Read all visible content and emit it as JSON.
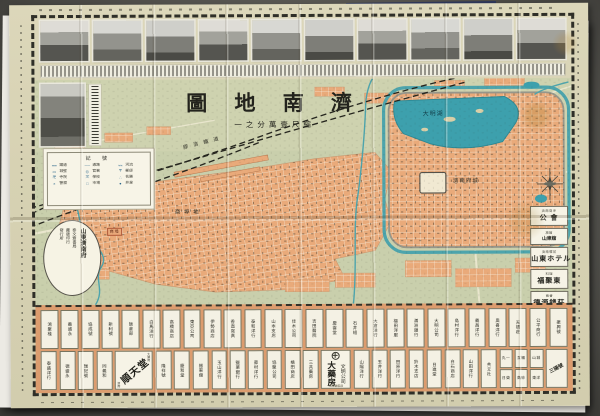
{
  "colors": {
    "paper": "#d7d2b3",
    "map_green": "#c9cfac",
    "block_orange": "#e9aa7a",
    "lake_teal": "#3da0ad",
    "ads_band": "#dc9c6e"
  },
  "title": {
    "text": "濟南地圖",
    "display": "圖 地 南 濟",
    "subtitle": "縮尺壹萬分之一",
    "subtitle_display": "一之分萬壹尺縮"
  },
  "photos_row": [
    "church-building",
    "river-landscape",
    "street-view",
    "cathedral-street",
    "government-building",
    "iron-bridge",
    "railway-station",
    "temple-gate",
    "garden-residence",
    "office-building"
  ],
  "left_photo": "spring-temple-photo",
  "legend": {
    "title": "記 號",
    "items": [
      {
        "sym": "━━",
        "label": "鐵道"
      },
      {
        "sym": "──",
        "label": "道路"
      },
      {
        "sym": "≈≈",
        "label": "河流"
      },
      {
        "sym": "▭",
        "label": "城壁"
      },
      {
        "sym": "◎",
        "label": "官署"
      },
      {
        "sym": "〒",
        "label": "郵便"
      },
      {
        "sym": "卍",
        "label": "寺院"
      },
      {
        "sym": "文",
        "label": "學校"
      },
      {
        "sym": "∴",
        "label": "名勝"
      },
      {
        "sym": "×",
        "label": "警察"
      },
      {
        "sym": "□",
        "label": "市場"
      },
      {
        "sym": "●",
        "label": "井泉"
      }
    ]
  },
  "cartouche": {
    "lines": [
      "山東濟南府",
      "泰文齋書局",
      "藏版印行",
      "發行所"
    ]
  },
  "map_labels": [
    {
      "text": "膠 濟 鐵 道"
    },
    {
      "text": "商 埠 地"
    },
    {
      "text": "大明湖"
    },
    {
      "text": "濟南府城"
    }
  ],
  "chip_label": "商埠",
  "right_boxes": [
    {
      "top": "濟南商埠",
      "big": "公 會"
    },
    {
      "top": "旅館",
      "big": "山東舘"
    },
    {
      "top": "濟南驛前",
      "big": "山東ホテル"
    },
    {
      "top": "料理",
      "big": "福聚東"
    },
    {
      "top": "兩替",
      "big": "德源錢莊"
    }
  ],
  "ads": {
    "row1": [
      "鴻聚棧",
      "義盛永",
      "協成號",
      "新利號",
      "飯倉部",
      "白馬洋行",
      "高橋商店",
      "東亞公司",
      "伊勢商店",
      "香直寫真",
      "泰和洋行",
      "山本支店",
      "佳木公司",
      "吉田醫院",
      "慶雲堂",
      "石井組",
      "大倉洋行",
      "福田洋服",
      "滿洲銀行",
      "大明公司",
      "島村洋行",
      "義昌洋行",
      "奧喜洋行",
      "天德莊",
      "公平商行",
      "振興號"
    ],
    "row2_g1": [
      "泰盛洋行",
      "德盛永",
      "瑞記號",
      "同義和"
    ],
    "row2_g2": [
      "隆祥號",
      "慶和堂",
      "振東舘"
    ],
    "row2_g3": [
      "玉山洋行",
      "鹽業銀行",
      "藤村洋行",
      "協聚公司",
      "橘田商店",
      "三共藥房"
    ],
    "row2_g4": [
      "山陽洋行",
      "玉井洋行",
      "田原洋行",
      "鈴木支店",
      "日進堂",
      "白石商店",
      "山田洋行",
      "共立社"
    ],
    "minigrid": [
      "丸一",
      "互福",
      "山城",
      "日榮",
      "高砂",
      "東洋"
    ],
    "juntendo": {
      "big": "順天堂",
      "small_tr": "大藥房",
      "small_bl": "濟南"
    },
    "bunmei": {
      "col1": "文明公司",
      "col2": "大藥房",
      "addr": "濟南魏家莊"
    },
    "rotated": "三陽號"
  }
}
